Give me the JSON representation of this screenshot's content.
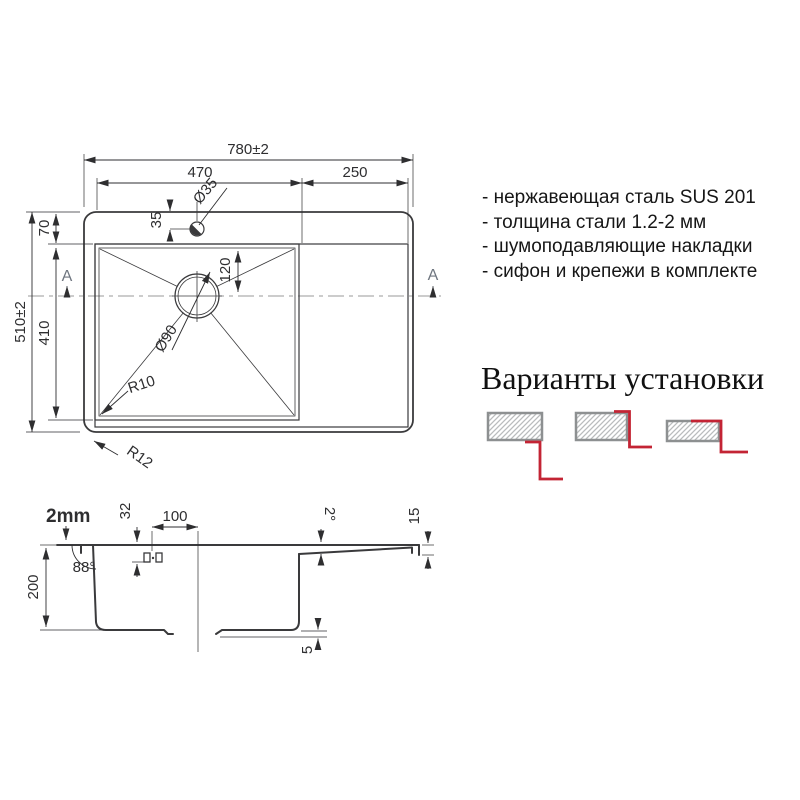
{
  "colors": {
    "line": "#3a3a3c",
    "dim": "#2e2e30",
    "centerline": "#9a9a9a",
    "marker": "#6f7680",
    "accent_red": "#c32434",
    "hatch_border": "#8d9091",
    "hatch_line": "#b9bcbd"
  },
  "top_view": {
    "section_marker": "A",
    "dims": {
      "overall_width": "780±2",
      "bowl_width": "470",
      "wing_width": "250",
      "overall_depth": "510±2",
      "top_offset": "70",
      "bowl_depth": "410",
      "faucet_offset": "35",
      "faucet_hole_dia": "Ø35",
      "drain_offset": "120",
      "drain_dia": "Ø90",
      "bowl_corner_radius": "R10",
      "outer_corner_radius": "R12"
    }
  },
  "section_view": {
    "dims": {
      "steel_thickness": "2mm",
      "bowl_depth": "200",
      "wall_angle": "88°",
      "faucet_height": "32",
      "faucet_to_drain": "100",
      "board_slope": "2°",
      "edge_height": "15",
      "recess": "5"
    }
  },
  "features": {
    "items": [
      "- нержавеющая сталь SUS 201",
      "- толщина стали 1.2-2 мм",
      "- шумоподавляющие накладки",
      "- сифон и крепежи в комплекте"
    ]
  },
  "install": {
    "title": "Варианты установки",
    "variants": [
      {
        "name": "undermount"
      },
      {
        "name": "flush-mount"
      },
      {
        "name": "top-mount"
      }
    ]
  }
}
